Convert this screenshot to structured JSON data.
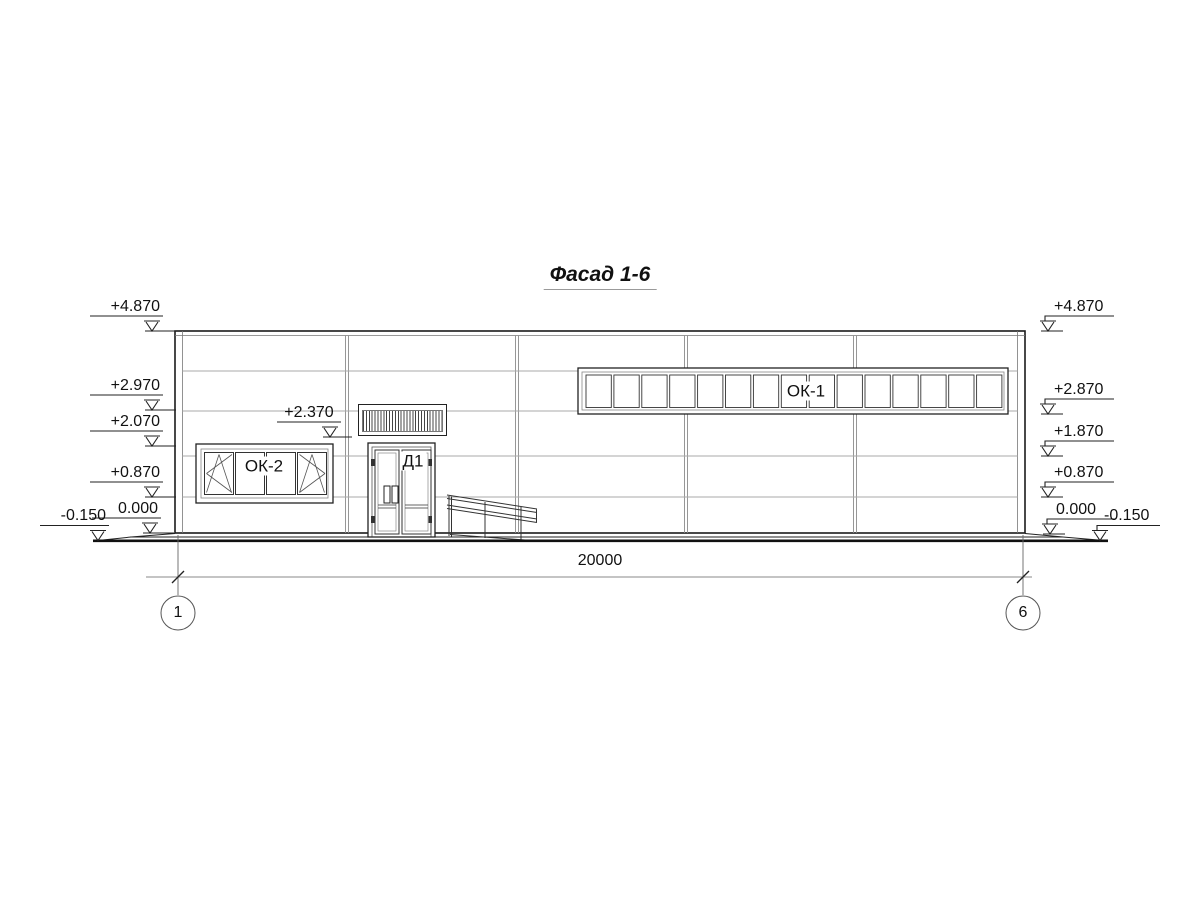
{
  "title": "Фасад 1-6",
  "facade": {
    "elevation_marks": {
      "left": [
        "+4.870",
        "+2.970",
        "+2.070",
        "+0.870",
        "0.000",
        "-0.150"
      ],
      "right": [
        "+4.870",
        "+2.870",
        "+1.870",
        "+0.870",
        "0.000",
        "-0.150"
      ],
      "above_entrance": "+2.370"
    },
    "labels": {
      "ribbon_window": "ОК-1",
      "left_window": "ОК-2",
      "door": "Д1"
    },
    "dimension": {
      "overall": "20000"
    },
    "axes": {
      "first": "1",
      "last": "6"
    },
    "colors": {
      "outline": "#1a1a1a",
      "joint": "#9a9a9a",
      "background": "#ffffff"
    }
  }
}
